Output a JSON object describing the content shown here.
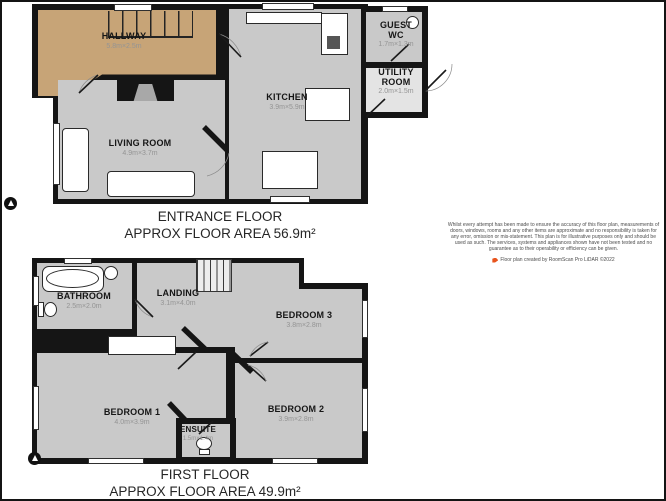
{
  "colors": {
    "wall": "#151515",
    "room_fill": "#c9c9c9",
    "hallway_fill": "#c7a477",
    "dims_text": "#949494",
    "credit_icon": "#e8541d",
    "background": "#ffffff"
  },
  "entrance_floor": {
    "title": "ENTRANCE FLOOR",
    "area_label": "APPROX FLOOR AREA 56.9m²",
    "rooms": {
      "hallway": {
        "name": "HALLWAY",
        "dims": "5.8m×2.5m"
      },
      "living_room": {
        "name": "LIVING ROOM",
        "dims": "4.9m×3.7m"
      },
      "kitchen": {
        "name": "KITCHEN",
        "dims": "3.9m×5.9m"
      },
      "guest_wc": {
        "name": "GUEST WC",
        "dims": "1.7m×1.3m"
      },
      "utility_room": {
        "name": "UTILITY ROOM",
        "dims": "2.0m×1.5m"
      }
    }
  },
  "first_floor": {
    "title": "FIRST FLOOR",
    "area_label": "APPROX FLOOR AREA 49.9m²",
    "rooms": {
      "bathroom": {
        "name": "BATHROOM",
        "dims": "2.5m×2.0m"
      },
      "landing": {
        "name": "LANDING",
        "dims": "3.1m×4.0m"
      },
      "bedroom_3": {
        "name": "BEDROOM 3",
        "dims": "3.8m×2.8m"
      },
      "bedroom_1": {
        "name": "BEDROOM 1",
        "dims": "4.0m×3.9m"
      },
      "bedroom_2": {
        "name": "BEDROOM 2",
        "dims": "3.9m×2.8m"
      },
      "ensuite": {
        "name": "ENSUITE",
        "dims": "1.5m×1.4m"
      }
    }
  },
  "disclaimer": {
    "text": "Whilst every attempt has been made to ensure the accuracy of this floor plan, measurements of doors, windows, rooms and any other items are approximate and no responsibility is taken for any error, omission or mis-statement. This plan is for illustrative purposes only and should be used as such. The services, systems and appliances shown have not been tested and no guarantee as to their operability or efficiency can be given.",
    "credit": "Floor plan created by RoomScan Pro LiDAR ©2022"
  }
}
